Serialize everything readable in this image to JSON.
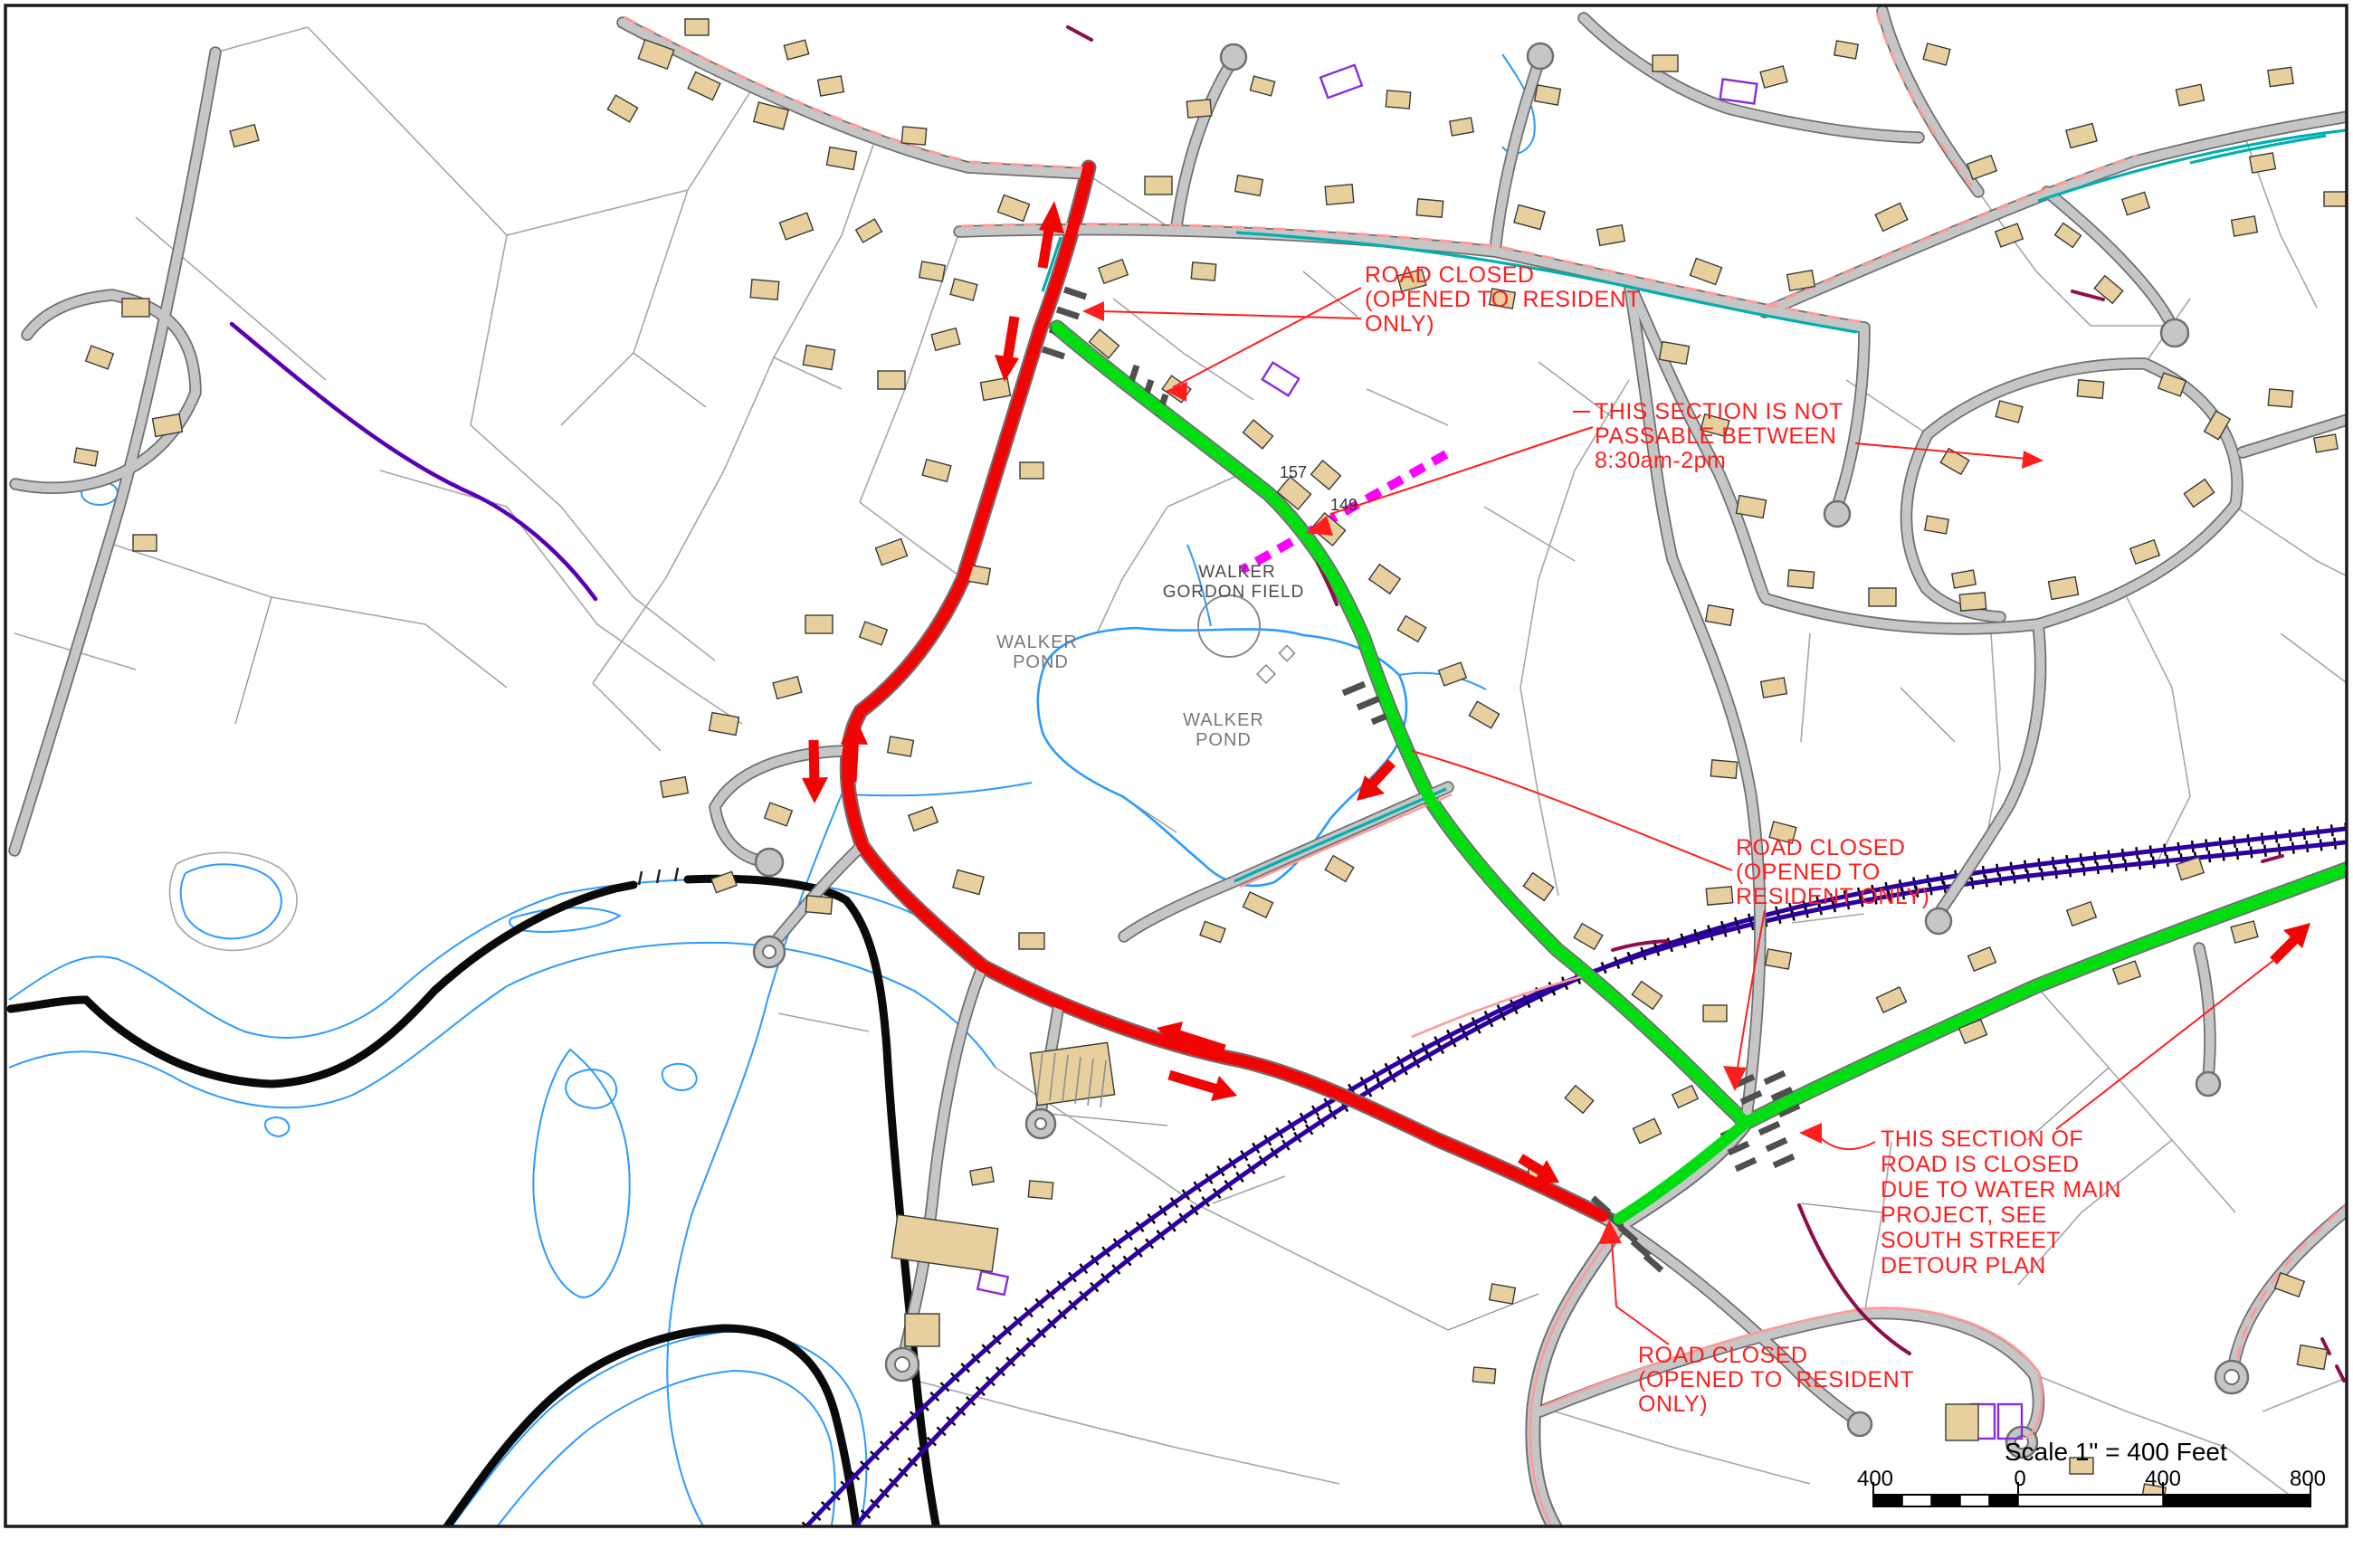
{
  "map": {
    "labels": {
      "walker_pond_upper": [
        "WALKER",
        "POND"
      ],
      "walker_pond_lower": [
        "WALKER",
        "POND"
      ],
      "walker_gordon_field": [
        "WALKER",
        "GORDON FIELD"
      ],
      "house_157": "157",
      "house_149": "149"
    },
    "annotations": {
      "a1": {
        "lines": [
          "ROAD CLOSED",
          "(OPENED TO  RESIDENT",
          "ONLY)"
        ]
      },
      "a2": {
        "lines": [
          "THIS SECTION IS NOT",
          "PASSABLE BETWEEN",
          "8:30am-2pm"
        ]
      },
      "a3": {
        "lines": [
          "ROAD CLOSED",
          "(OPENED TO",
          "RESIDENT ONLY)"
        ]
      },
      "a4": {
        "lines": [
          "THIS SECTION OF",
          "ROAD IS CLOSED",
          "DUE TO WATER MAIN",
          "PROJECT, SEE",
          "SOUTH STREET",
          "DETOUR PLAN"
        ]
      },
      "a5": {
        "lines": [
          "ROAD CLOSED",
          "(OPENED TO  RESIDENT",
          "ONLY)"
        ]
      }
    },
    "scale": {
      "title": "Scale 1\" = 400 Feet",
      "ticks": [
        "400",
        "0",
        "400",
        "800"
      ]
    },
    "colors": {
      "annotation_red": "#ff1e1e",
      "closed_route_red": "#f00505",
      "detour_route_green": "#00de12",
      "water_blue": "#2b9bff",
      "railroad_purple": "#2e00a0",
      "boundary_black": "#0a0a0a",
      "not_passable_magenta": "#ff00ff",
      "building_tan": "#e7d09e",
      "road_gray": "#c6c6c6",
      "utility_teal": "#00afaf",
      "utility_salmon": "#ff9a9a",
      "utility_maroon": "#8e0d4b",
      "court_violet": "#8a2be2"
    }
  }
}
